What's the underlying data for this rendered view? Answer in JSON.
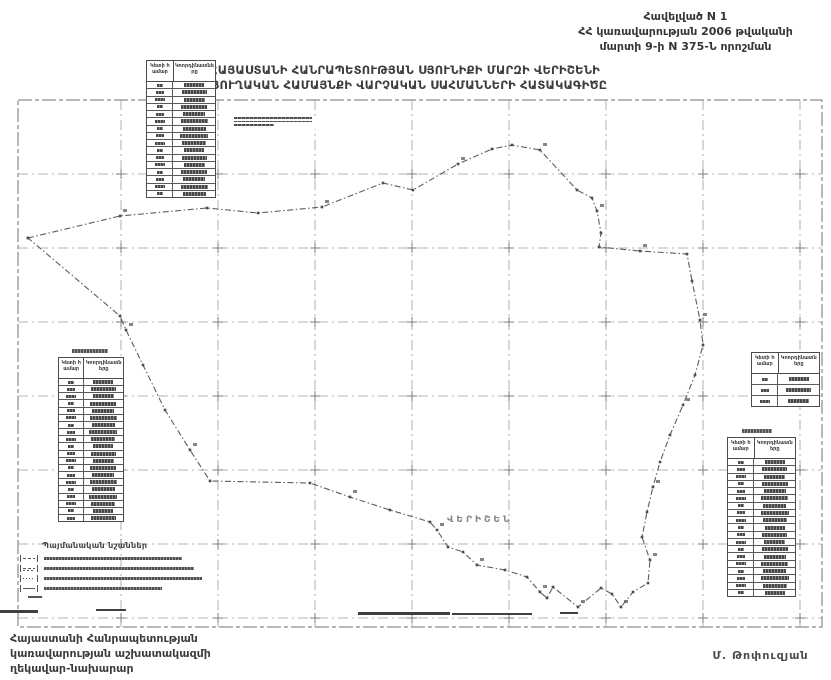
{
  "appendix": {
    "line1": "Հավելված N 1",
    "line2": "ՀՀ կառավարության 2006 թվականի",
    "line3": "մարտի 9-ի N 375-Ն որոշման"
  },
  "title": {
    "line1": "ՀԱՅԱՍՏԱՆԻ ՀԱՆՐԱՊԵՏՈՒԹՅԱՆ ՍՅՈՒՆԻՔԻ ՄԱՐԶԻ ՎԵՐԻՇԵՆԻ",
    "line2": "ԳՅՈՒՂԱԿԱՆ ՀԱՄԱՅՆՔԻ ՎԱՐՉԱԿԱՆ ՍԱՀՄԱՆՆԵՐԻ ՀԱՏԱԿԱԳԻԾԸ"
  },
  "map": {
    "settlement_label": "ՎԵՐԻՇԵՆ",
    "frame": {
      "x": 18,
      "y": 100,
      "w": 804,
      "h": 527
    },
    "grid": {
      "vertical_x": [
        121,
        218,
        315,
        412,
        509,
        606,
        703,
        800
      ],
      "horizontal_y": [
        174,
        248,
        322,
        396,
        470,
        544,
        618
      ]
    },
    "boundary_points": [
      [
        28,
        238
      ],
      [
        120,
        216
      ],
      [
        207,
        208
      ],
      [
        258,
        213
      ],
      [
        322,
        207
      ],
      [
        383,
        183
      ],
      [
        413,
        190
      ],
      [
        458,
        164
      ],
      [
        492,
        149
      ],
      [
        512,
        145
      ],
      [
        540,
        150
      ],
      [
        577,
        190
      ],
      [
        592,
        198
      ],
      [
        597,
        211
      ],
      [
        601,
        233
      ],
      [
        599,
        247
      ],
      [
        640,
        251
      ],
      [
        687,
        254
      ],
      [
        692,
        281
      ],
      [
        700,
        320
      ],
      [
        703,
        345
      ],
      [
        695,
        375
      ],
      [
        683,
        405
      ],
      [
        670,
        435
      ],
      [
        660,
        462
      ],
      [
        653,
        487
      ],
      [
        647,
        512
      ],
      [
        642,
        537
      ],
      [
        650,
        560
      ],
      [
        648,
        583
      ],
      [
        633,
        592
      ],
      [
        621,
        607
      ],
      [
        612,
        594
      ],
      [
        601,
        588
      ],
      [
        578,
        607
      ],
      [
        553,
        587
      ],
      [
        547,
        598
      ],
      [
        540,
        592
      ],
      [
        527,
        577
      ],
      [
        505,
        570
      ],
      [
        477,
        565
      ],
      [
        463,
        552
      ],
      [
        448,
        547
      ],
      [
        437,
        530
      ],
      [
        430,
        522
      ],
      [
        390,
        510
      ],
      [
        350,
        497
      ],
      [
        310,
        483
      ],
      [
        210,
        481
      ],
      [
        190,
        450
      ],
      [
        165,
        410
      ],
      [
        143,
        365
      ],
      [
        126,
        330
      ],
      [
        120,
        316
      ],
      [
        28,
        238
      ]
    ],
    "artifacts": [
      [
        0,
        610,
        38,
        3
      ],
      [
        96,
        609,
        30,
        2
      ],
      [
        358,
        612,
        92,
        3
      ],
      [
        452,
        613,
        80,
        2
      ],
      [
        560,
        612,
        18,
        2
      ]
    ]
  },
  "tables": [
    {
      "id": "nw",
      "col1": "Կետի համար",
      "col2": "Կոորդինատները",
      "rows": 16
    },
    {
      "id": "west",
      "col1": "Կետի համար",
      "col2": "Կոորդինատները",
      "rows": 20
    },
    {
      "id": "east-small",
      "col1": "Կետի համար",
      "col2": "Կոորդինատները",
      "rows": 3
    },
    {
      "id": "east",
      "col1": "Կետի համար",
      "col2": "Կոորդինատները",
      "rows": 19
    }
  ],
  "legend": {
    "title": "Պայմանական նշաններ",
    "items": [
      {
        "symbol": "dash-dot-line"
      },
      {
        "symbol": "double-line"
      },
      {
        "symbol": "point-number"
      },
      {
        "symbol": "solid-line"
      }
    ]
  },
  "footer": {
    "line1": "Հայաստանի Հանրապետության",
    "line2": "կառավարության աշխատակազմի",
    "line3": "ղեկավար-նախարար"
  },
  "signature": "Մ. Թոփուզյան"
}
